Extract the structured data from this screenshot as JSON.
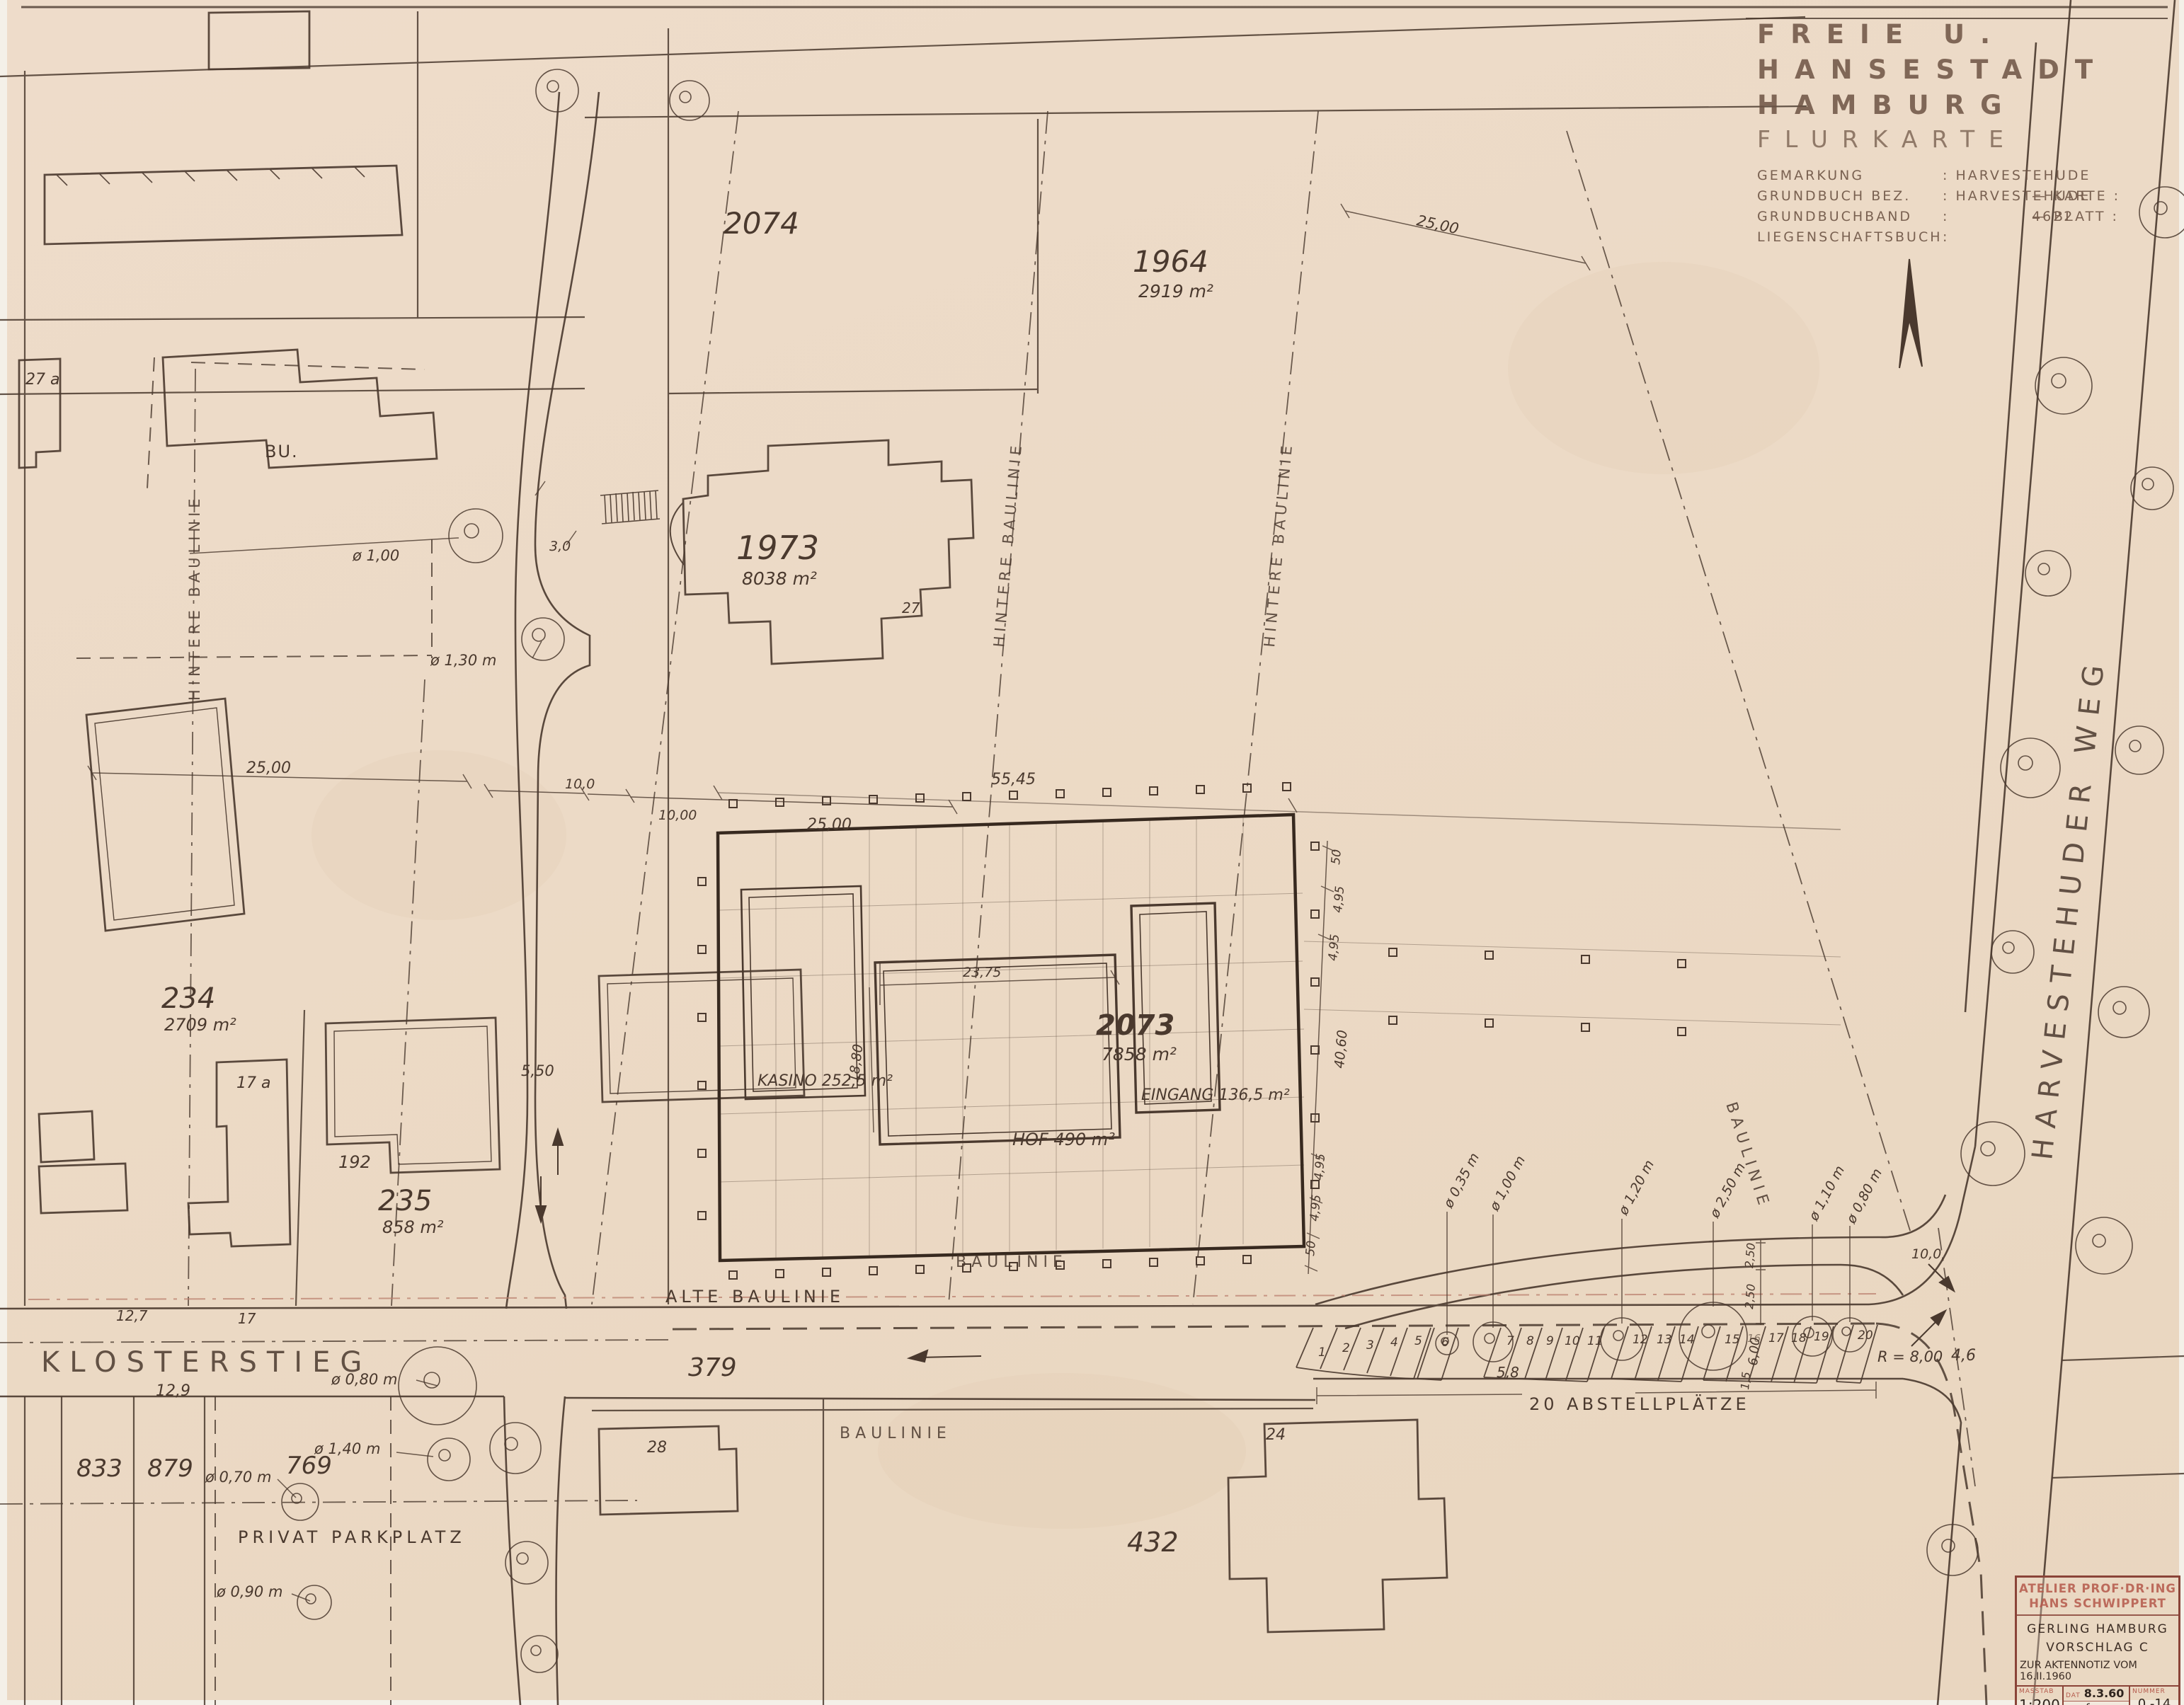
{
  "colors": {
    "paper": "#ecdcc7",
    "ink": "#4a392e",
    "red_stamp": "#a8503f",
    "faded_red": "#b97f6e"
  },
  "title_block": {
    "line1": "FREIE U. HANSESTADT",
    "line2": "HAMBURG",
    "line3": "FLURKARTE",
    "rows": [
      {
        "label": "GEMARKUNG",
        "value": ": HARVESTEHUDE",
        "note": ""
      },
      {
        "label": "GRUNDBUCH BEZ.",
        "value": ": HARVESTEHUDE",
        "note": "— KARTE : 4622"
      },
      {
        "label": "GRUNDBUCHBAND",
        "value": ":",
        "note": "— BLATT :"
      },
      {
        "label": "LIEGENSCHAFTSBUCH",
        "value": ":",
        "note": ""
      }
    ]
  },
  "stamp": {
    "atelier1": "ATELIER PROF·DR·ING",
    "atelier2": "HANS SCHWIPPERT",
    "project1": "GERLING HAMBURG",
    "project2": "VORSCHLAG C",
    "note": "ZUR AKTENNOTIZ VOM 16.II.1960",
    "masstab_label": "MASSTAB",
    "masstab": "1:200",
    "dat_label": "DAT",
    "dat": "8.3.60",
    "gez_label": "GEZ",
    "gez": "fe",
    "grg_label": "GRG",
    "grg": "84/107",
    "nummer_label": "NUMMER",
    "nummer": "0 -14"
  },
  "streets": {
    "klosterstieg": "KLOSTERSTIEG",
    "harvestehuder_weg": "HARVESTEHUDER WEG"
  },
  "parcels": {
    "p2074": {
      "number": "2074",
      "area": ""
    },
    "p1964": {
      "number": "1964",
      "area": "2919 m²"
    },
    "p1973": {
      "number": "1973",
      "area": "8038 m²"
    },
    "p2073": {
      "number": "2073",
      "area": "7858 m²"
    },
    "p234": {
      "number": "234",
      "area": "2709 m²"
    },
    "p235": {
      "number": "235",
      "area": "858 m²"
    },
    "p833": {
      "number": "833"
    },
    "p879": {
      "number": "879"
    },
    "p769": {
      "number": "769"
    },
    "p432": {
      "number": "432"
    },
    "p379": {
      "number": "379"
    }
  },
  "buildings": {
    "b27a": "27 a",
    "bu": "BU.",
    "b17a": "17 a",
    "b192": "192",
    "b28": "28",
    "b24": "24",
    "b27": "27"
  },
  "annotations": {
    "baulinie": "BAULINIE",
    "hintere_baulinie": "HINTERE BAULINIE",
    "alte_baulinie": "ALTE BAULINIE",
    "privat_parkplatz": "PRIVAT PARKPLATZ",
    "abstellplaetze": "20 ABSTELLPLÄTZE",
    "kasino": "KASINO 252,5 m²",
    "eingang": "EINGANG 136,5 m²",
    "hof": "HOF 490 m²"
  },
  "dimensions": {
    "d25_left": "25,00",
    "d10a": "10,0",
    "d10b": "10,00",
    "d25_mid": "25,00",
    "d55": "55,45",
    "d25_ne": "25,00",
    "d2375": "23,75",
    "d1880": "18,80",
    "d50a": "50",
    "d495a": "4,95",
    "d495b": "4,95",
    "d4060": "40,60",
    "d495c": "4,95",
    "d495d": "4,95",
    "d50b": "50",
    "d550": "5,50",
    "d30": "3,0",
    "d58": "5,8",
    "d600": "6,00",
    "d15": "1,5",
    "r800": "R = 8,00",
    "d46": "4,6",
    "d100": "10,0",
    "d250a": "2,50",
    "d250b": "2,50",
    "d129": "12,9",
    "d127": "12,7",
    "d17": "17"
  },
  "trees": {
    "labels": [
      "ø 1,00",
      "ø 1,30 m",
      "ø 0,80 m",
      "ø 1,40 m",
      "ø 0,70 m",
      "ø 0,90 m",
      "ø 0,35 m",
      "ø 1,00 m",
      "ø 1,20 m",
      "ø 2,50 m",
      "ø 1,10 m",
      "ø 0,80 m"
    ]
  },
  "parking": {
    "stalls": [
      "1",
      "2",
      "3",
      "4",
      "5",
      "6",
      "7",
      "8",
      "9",
      "10",
      "11",
      "12",
      "13",
      "14",
      "15",
      "16",
      "17",
      "18",
      "19",
      "20"
    ]
  }
}
